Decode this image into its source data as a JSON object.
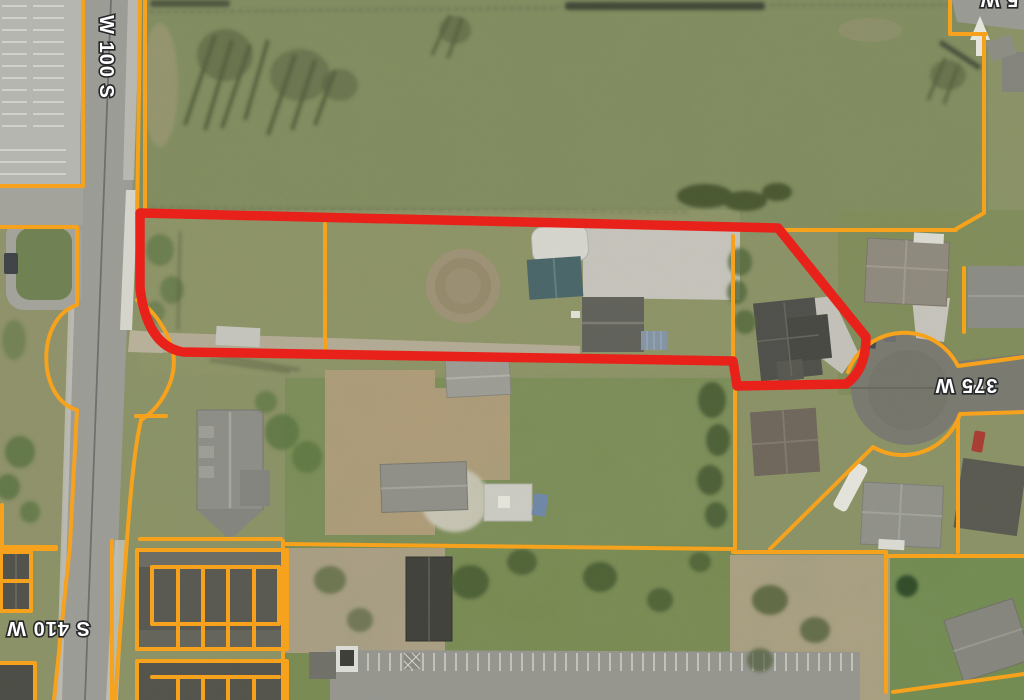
{
  "map": {
    "view": "aerial-parcel-map",
    "street_labels": [
      {
        "id": "w-100-s",
        "text": "W 100 S",
        "orientation": "rotated-90-vertical"
      },
      {
        "id": "s-410-w",
        "text": "S 410 W",
        "orientation": "rotated-180"
      },
      {
        "id": "375-w",
        "text": "375 W",
        "orientation": "rotated-180"
      },
      {
        "id": "top-right-partial",
        "text": "5 W",
        "orientation": "rotated-180-clipped-at-top-edge"
      }
    ],
    "colors": {
      "parcel_line": "#F6A21D",
      "highlight_outline": "#E8221A",
      "field_green": "#7F8B5D",
      "road_gray": "#9C9C96",
      "cul_de_sac_asphalt": "#78786F"
    }
  }
}
